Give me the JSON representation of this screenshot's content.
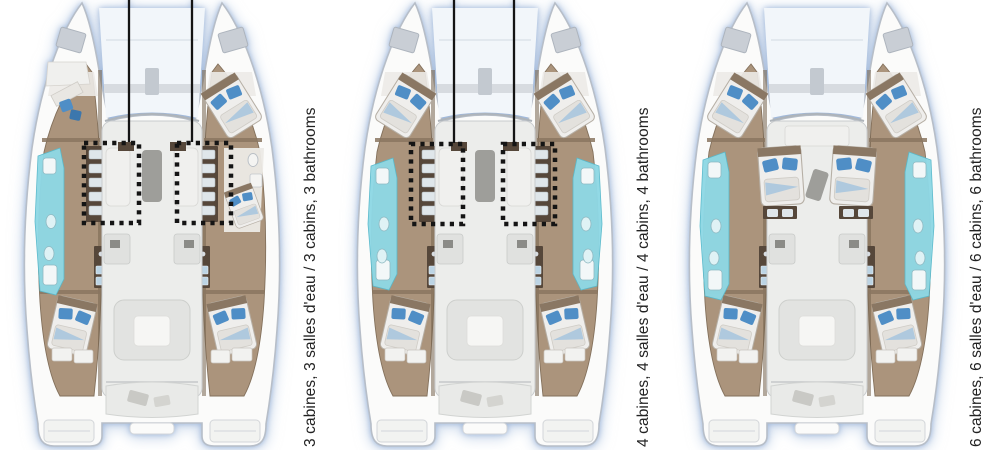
{
  "title": "Catamaran cabin layout comparison",
  "colors": {
    "hull_fill": "#fbfbfa",
    "hull_stroke": "#b7bec8",
    "trampoline": "#f2f6fa",
    "beam_gray": "#d7dbe0",
    "hatch_gray": "#c9ced5",
    "floor_tan": "#ab947c",
    "floor_tan_stroke": "#83705b",
    "wall_dark": "#77644f",
    "wood_dark": "#56473a",
    "salon_floor": "#ecedeb",
    "salon_stroke": "#c9ccce",
    "furniture_white": "#f0f0ee",
    "furniture_gray": "#e0e1df",
    "table_gray": "#9e9e9a",
    "bath_cyan": "#8ed8e5",
    "bath_cyan_stroke": "#58b9cb",
    "bed_blue": "#4f8ec6",
    "bed_blue_light": "#9dc0de",
    "marker_black": "#141414",
    "label_color": "#222222"
  },
  "boats": [
    {
      "name": "layout-3-cabins",
      "label": "3 cabines, 3 salles d'eau / 3 cabins, 3 bathrooms",
      "cabins": 3,
      "bathrooms": 3,
      "markers": {
        "rects": [
          {
            "x": 82,
            "y": 143,
            "w": 55,
            "h": 80
          },
          {
            "x": 175,
            "y": 143,
            "w": 54,
            "h": 80
          }
        ],
        "leaders": [
          127,
          190
        ]
      },
      "features": {
        "left_bath": [
          148,
          295
        ],
        "right_bath": null,
        "left_fwd": "desk",
        "right_fwd": "bed",
        "right_mid_bed": true,
        "mid_beds": false,
        "appliance_columns": "mid",
        "galley_front": true
      }
    },
    {
      "name": "layout-4-cabins",
      "label": "4 cabines, 4 salles d'eau / 4 cabins, 4 bathrooms",
      "cabins": 4,
      "bathrooms": 4,
      "markers": {
        "rects": [
          {
            "x": 76,
            "y": 144,
            "w": 52,
            "h": 80
          },
          {
            "x": 168,
            "y": 144,
            "w": 52,
            "h": 80
          }
        ],
        "leaders": [
          119,
          179
        ]
      },
      "features": {
        "left_bath": [
          158,
          290
        ],
        "right_bath": [
          158,
          290
        ],
        "left_fwd": "bed",
        "right_fwd": "bed",
        "right_mid_bed": false,
        "mid_beds": false,
        "appliance_columns": "mid",
        "galley_front": true
      }
    },
    {
      "name": "layout-6-cabins",
      "label": "6 cabines, 6 salles d'eau / 6 cabins, 6 bathrooms",
      "cabins": 6,
      "bathrooms": 6,
      "markers": null,
      "features": {
        "left_bath": [
          152,
          300
        ],
        "right_bath": [
          152,
          300
        ],
        "left_fwd": "bed",
        "right_fwd": "bed",
        "right_mid_bed": false,
        "mid_beds": true,
        "appliance_columns": "aft",
        "galley_front": false
      }
    }
  ]
}
